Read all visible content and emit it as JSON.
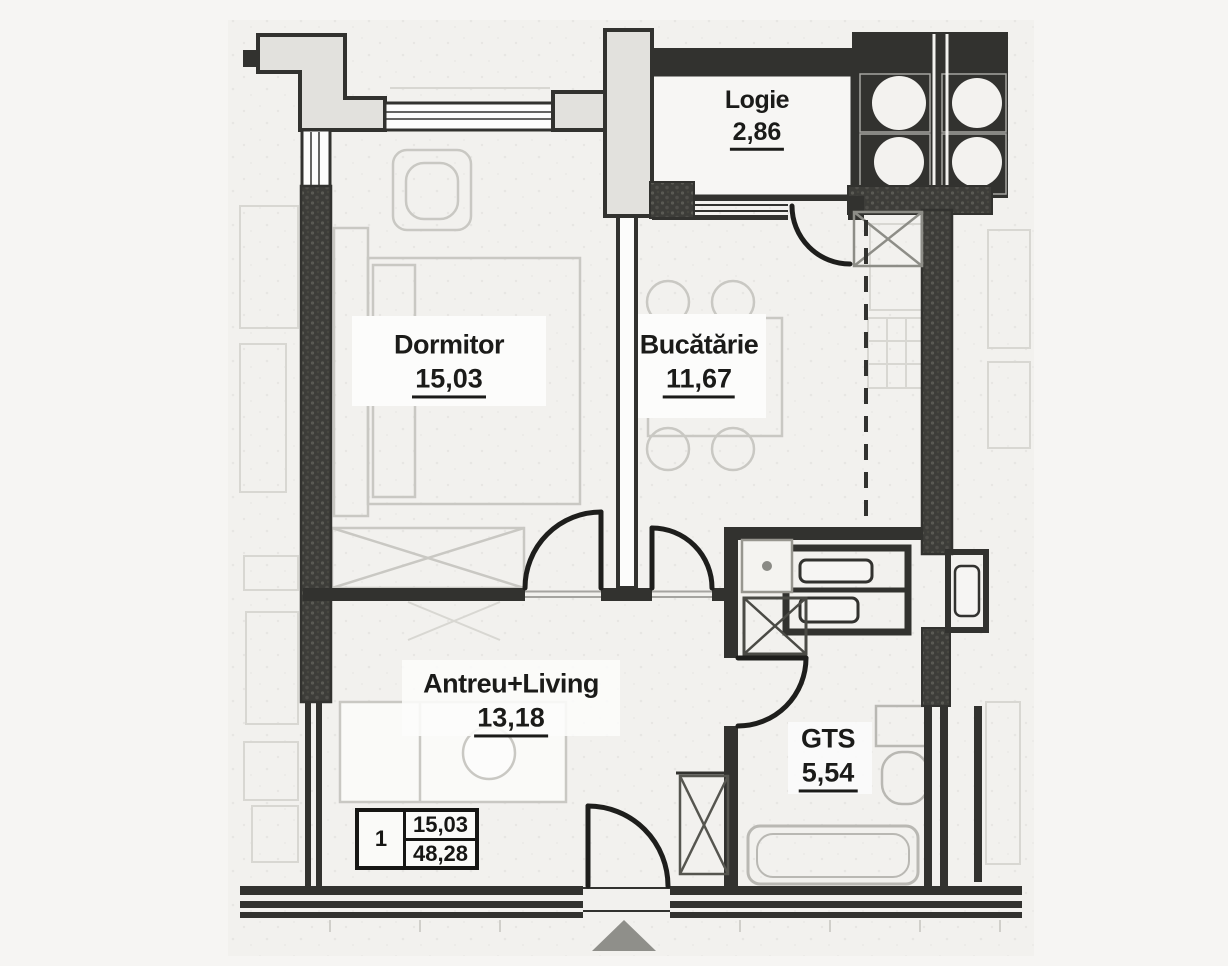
{
  "rooms": [
    {
      "id": "logie",
      "name": "Logie",
      "area": "2,86"
    },
    {
      "id": "dormitor",
      "name": "Dormitor",
      "area": "15,03"
    },
    {
      "id": "bucatarie",
      "name": "Bucătărie",
      "area": "11,67"
    },
    {
      "id": "antreu_living",
      "name": "Antreu+Living",
      "area": "13,18"
    },
    {
      "id": "gts",
      "name": "GTS",
      "area": "5,54"
    }
  ],
  "info_table": {
    "unit_number": "1",
    "value_top": "15,03",
    "value_bottom": "48,28"
  },
  "colors": {
    "wall": "#32322f",
    "wall_light_fill": "#e2e1dd",
    "paper": "#f6f5f3",
    "plan_paper": "#f2f1ee",
    "faint_furniture": "#c9c8c3",
    "neighbor_faint": "#d8d7d2",
    "label_text": "#1b1b19",
    "entrance_marker": "#8f8f8a"
  }
}
